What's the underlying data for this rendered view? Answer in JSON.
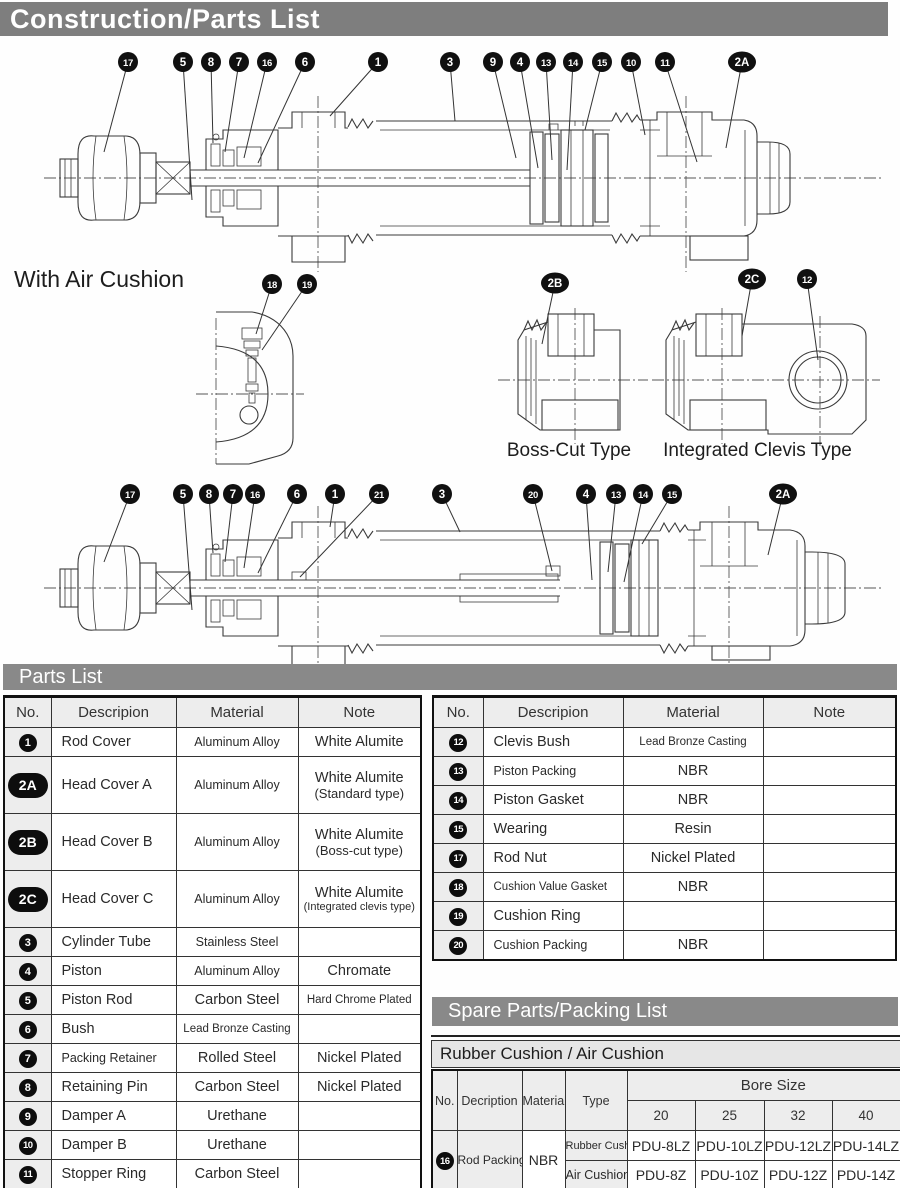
{
  "title_bar": {
    "text": "Construction/Parts List"
  },
  "diagrams": {
    "with_air_cushion_label": "With Air Cushion",
    "boss_cut_label": "Boss-Cut Type",
    "integrated_clevis_label": "Integrated Clevis Type",
    "callouts": {
      "standard": [
        {
          "t": "17",
          "x": 128,
          "y": 62,
          "tx": 104,
          "ty": 152
        },
        {
          "t": "5",
          "x": 183,
          "y": 62,
          "tx": 192,
          "ty": 200
        },
        {
          "t": "8",
          "x": 211,
          "y": 62,
          "tx": 213,
          "ty": 143
        },
        {
          "t": "7",
          "x": 239,
          "y": 62,
          "tx": 225,
          "ty": 152
        },
        {
          "t": "16",
          "x": 267,
          "y": 62,
          "tx": 244,
          "ty": 158
        },
        {
          "t": "6",
          "x": 305,
          "y": 62,
          "tx": 258,
          "ty": 163
        },
        {
          "t": "1",
          "x": 378,
          "y": 62,
          "tx": 330,
          "ty": 116
        },
        {
          "t": "3",
          "x": 450,
          "y": 62,
          "tx": 455,
          "ty": 121
        },
        {
          "t": "9",
          "x": 493,
          "y": 62,
          "tx": 516,
          "ty": 158
        },
        {
          "t": "4",
          "x": 520,
          "y": 62,
          "tx": 538,
          "ty": 168
        },
        {
          "t": "13",
          "x": 546,
          "y": 62,
          "tx": 552,
          "ty": 160
        },
        {
          "t": "14",
          "x": 573,
          "y": 62,
          "tx": 567,
          "ty": 170
        },
        {
          "t": "15",
          "x": 602,
          "y": 62,
          "tx": 585,
          "ty": 130
        },
        {
          "t": "10",
          "x": 631,
          "y": 62,
          "tx": 645,
          "ty": 135
        },
        {
          "t": "11",
          "x": 665,
          "y": 62,
          "tx": 697,
          "ty": 162
        },
        {
          "t": "2A",
          "x": 742,
          "y": 62,
          "tx": 726,
          "ty": 148
        }
      ],
      "air_cushion": [
        {
          "t": "17",
          "x": 130,
          "y": 494,
          "tx": 104,
          "ty": 562
        },
        {
          "t": "5",
          "x": 183,
          "y": 494,
          "tx": 192,
          "ty": 610
        },
        {
          "t": "8",
          "x": 209,
          "y": 494,
          "tx": 213,
          "ty": 553
        },
        {
          "t": "7",
          "x": 233,
          "y": 494,
          "tx": 225,
          "ty": 562
        },
        {
          "t": "16",
          "x": 255,
          "y": 494,
          "tx": 244,
          "ty": 568
        },
        {
          "t": "6",
          "x": 297,
          "y": 494,
          "tx": 258,
          "ty": 573
        },
        {
          "t": "1",
          "x": 335,
          "y": 494,
          "tx": 330,
          "ty": 527
        },
        {
          "t": "21",
          "x": 379,
          "y": 494,
          "tx": 300,
          "ty": 577
        },
        {
          "t": "3",
          "x": 442,
          "y": 494,
          "tx": 460,
          "ty": 532
        },
        {
          "t": "20",
          "x": 533,
          "y": 494,
          "tx": 552,
          "ty": 571
        },
        {
          "t": "4",
          "x": 586,
          "y": 494,
          "tx": 592,
          "ty": 580
        },
        {
          "t": "13",
          "x": 616,
          "y": 494,
          "tx": 608,
          "ty": 572
        },
        {
          "t": "14",
          "x": 643,
          "y": 494,
          "tx": 624,
          "ty": 582
        },
        {
          "t": "15",
          "x": 672,
          "y": 494,
          "tx": 642,
          "ty": 544
        },
        {
          "t": "2A",
          "x": 783,
          "y": 494,
          "tx": 768,
          "ty": 555
        }
      ],
      "cushion_detail": [
        {
          "t": "18",
          "x": 272,
          "y": 284,
          "tx": 256,
          "ty": 334
        },
        {
          "t": "19",
          "x": 307,
          "y": 284,
          "tx": 262,
          "ty": 350
        }
      ],
      "boss_cut": [
        {
          "t": "2B",
          "x": 555,
          "y": 283,
          "tx": 542,
          "ty": 344
        }
      ],
      "clevis": [
        {
          "t": "2C",
          "x": 752,
          "y": 279,
          "tx": 742,
          "ty": 336
        },
        {
          "t": "12",
          "x": 807,
          "y": 279,
          "tx": 818,
          "ty": 360
        }
      ]
    }
  },
  "parts_list": {
    "bar_label": "Parts List",
    "headers": [
      "No.",
      "Descripion",
      "Material",
      "Note"
    ],
    "left_rows": [
      {
        "no": "1",
        "desc": "Rod Cover",
        "material": "Aluminum Alloy",
        "note": "White Alumite"
      },
      {
        "no": "2A",
        "desc": "Head Cover A",
        "material": "Aluminum Alloy",
        "note": "White Alumite",
        "note2": "(Standard type)"
      },
      {
        "no": "2B",
        "desc": "Head Cover B",
        "material": "Aluminum Alloy",
        "note": "White Alumite",
        "note2": "(Boss-cut type)"
      },
      {
        "no": "2C",
        "desc": "Head Cover C",
        "material": "Aluminum Alloy",
        "note": "White Alumite",
        "note2": "(Integrated clevis type)"
      },
      {
        "no": "3",
        "desc": "Cylinder Tube",
        "material": "Stainless Steel",
        "note": ""
      },
      {
        "no": "4",
        "desc": "Piston",
        "material": "Aluminum Alloy",
        "note": "Chromate"
      },
      {
        "no": "5",
        "desc": "Piston Rod",
        "material": "Carbon Steel",
        "note": "Hard Chrome Plated"
      },
      {
        "no": "6",
        "desc": "Bush",
        "material": "Lead Bronze Casting",
        "note": ""
      },
      {
        "no": "7",
        "desc": "Packing Retainer",
        "material": "Rolled Steel",
        "note": "Nickel Plated"
      },
      {
        "no": "8",
        "desc": "Retaining Pin",
        "material": "Carbon Steel",
        "note": "Nickel Plated"
      },
      {
        "no": "9",
        "desc": "Damper A",
        "material": "Urethane",
        "note": ""
      },
      {
        "no": "10",
        "desc": "Damper B",
        "material": "Urethane",
        "note": ""
      },
      {
        "no": "11",
        "desc": "Stopper Ring",
        "material": "Carbon Steel",
        "note": ""
      }
    ],
    "right_rows": [
      {
        "no": "12",
        "desc": "Clevis Bush",
        "material": "Lead Bronze Casting",
        "note": ""
      },
      {
        "no": "13",
        "desc": "Piston Packing",
        "material": "NBR",
        "note": ""
      },
      {
        "no": "14",
        "desc": "Piston Gasket",
        "material": "NBR",
        "note": ""
      },
      {
        "no": "15",
        "desc": "Wearing",
        "material": "Resin",
        "note": ""
      },
      {
        "no": "17",
        "desc": "Rod Nut",
        "material": "Nickel Plated",
        "note": ""
      },
      {
        "no": "18",
        "desc": "Cushion Value Gasket",
        "material": "NBR",
        "note": ""
      },
      {
        "no": "19",
        "desc": "Cushion Ring",
        "material": "",
        "note": ""
      },
      {
        "no": "20",
        "desc": "Cushion Packing",
        "material": "NBR",
        "note": ""
      }
    ]
  },
  "spare_parts": {
    "bar_label": "Spare Parts/Packing List",
    "subtitle": "Rubber Cushion / Air Cushion",
    "col_headers": [
      "No.",
      "Decription",
      "Material",
      "Type"
    ],
    "bore_size_label": "Bore Size",
    "bore_sizes": [
      "20",
      "25",
      "32",
      "40"
    ],
    "row": {
      "no": "16",
      "desc": "Rod Packing",
      "material": "NBR"
    },
    "type_rows": [
      {
        "type": "Rubber Cushion",
        "values": [
          "PDU-8LZ",
          "PDU-10LZ",
          "PDU-12LZ",
          "PDU-14LZ"
        ]
      },
      {
        "type": "Air Cushion",
        "values": [
          "PDU-8Z",
          "PDU-10Z",
          "PDU-12Z",
          "PDU-14Z"
        ]
      }
    ],
    "clipped_text": "1"
  }
}
